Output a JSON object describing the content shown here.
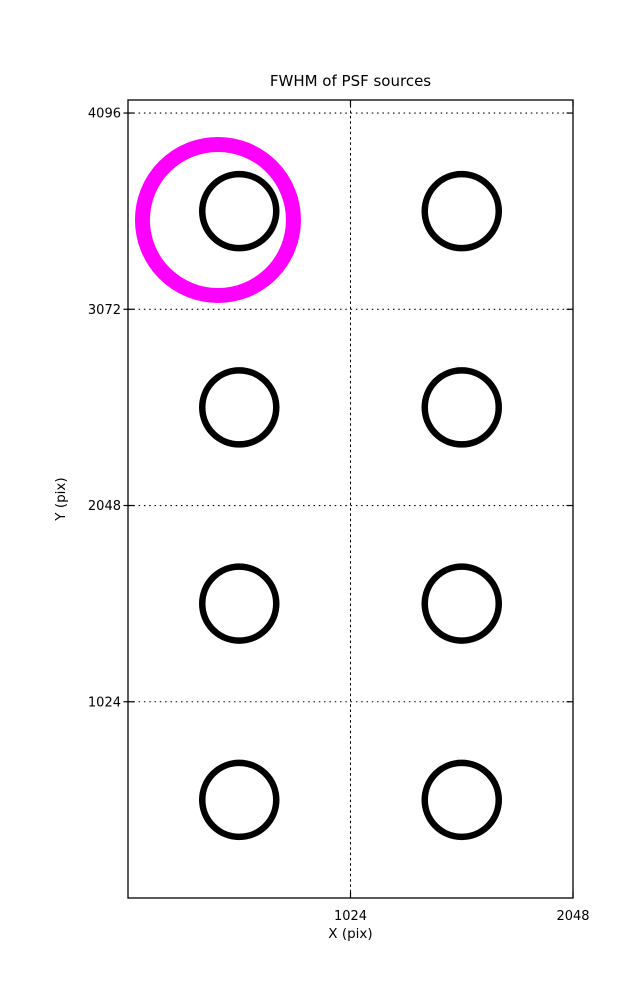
{
  "figure": {
    "background": "#ffffff",
    "frame_color": "#000000"
  },
  "chart_data": {
    "type": "scatter",
    "title": "FWHM of PSF sources",
    "xlabel": "X (pix)",
    "ylabel": "Y (pix)",
    "xlim": [
      0,
      2048
    ],
    "ylim": [
      0,
      4164
    ],
    "xticks": [
      1024,
      2048
    ],
    "yticks": [
      1024,
      2048,
      3072,
      4096
    ],
    "grid": true,
    "grid_style": "dotted",
    "legend": "none",
    "series": [
      {
        "name": "psf-grid-sources",
        "label": "PSF source positions",
        "marker": "open-circle",
        "color": "#000000",
        "radius_px": 37,
        "stroke_px": 6.5,
        "points": [
          {
            "x": 512,
            "y": 3584
          },
          {
            "x": 1536,
            "y": 3584
          },
          {
            "x": 512,
            "y": 2560
          },
          {
            "x": 1536,
            "y": 2560
          },
          {
            "x": 512,
            "y": 1536
          },
          {
            "x": 1536,
            "y": 1536
          },
          {
            "x": 512,
            "y": 512
          },
          {
            "x": 1536,
            "y": 512
          }
        ]
      },
      {
        "name": "highlighted-fwhm-source",
        "label": "Highlighted FWHM source",
        "marker": "open-circle",
        "color": "#ff00ff",
        "radius_px": 75.5,
        "stroke_px": 15,
        "points": [
          {
            "x": 414,
            "y": 3538
          }
        ]
      }
    ]
  }
}
